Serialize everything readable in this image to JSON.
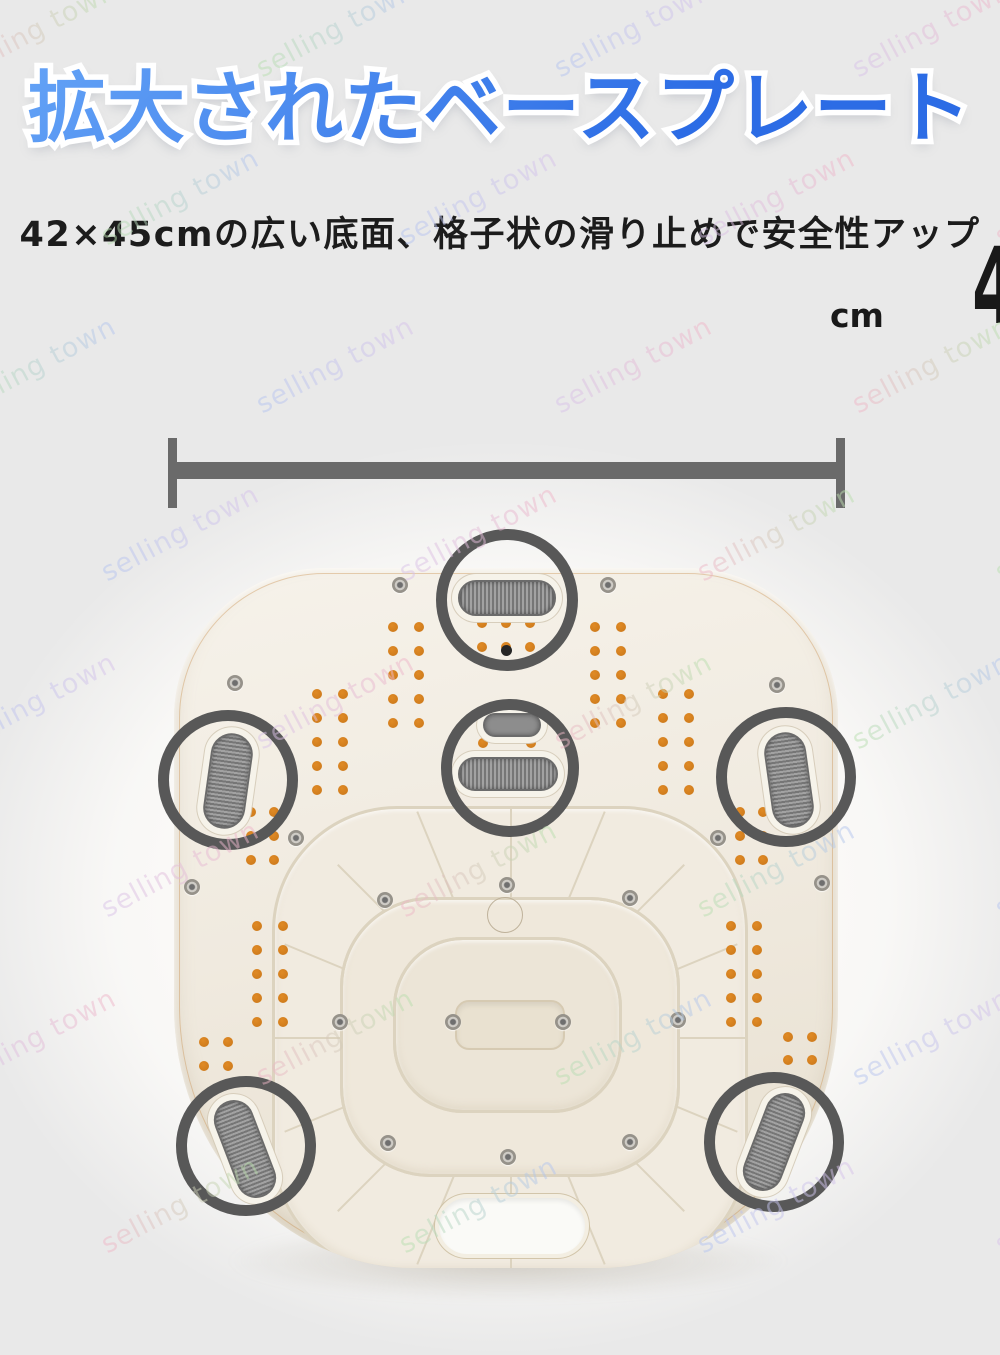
{
  "canvas": {
    "width": 1000,
    "height": 1355,
    "background": "#e9e9e9"
  },
  "header": {
    "title": {
      "text": "拡大されたベースプレート",
      "gradient_top": "#63a2f6",
      "gradient_bottom": "#2c6ce5",
      "outline_color": "#ffffff"
    },
    "subtitle": {
      "text": "42×45cmの広い底面、格子状の滑り止めで安全性アップ",
      "color": "#1c1c1c"
    }
  },
  "dimension": {
    "value": "42×45",
    "unit": "cm",
    "text_color": "#191919",
    "line_color": "#6a6a6a"
  },
  "watermark": {
    "text": "selling town",
    "colors": [
      "#f0b6c8",
      "#b9e0ae",
      "#b4c5f0",
      "#d8c3ea"
    ],
    "opacity": 0.5,
    "rotation_deg": -28,
    "font_size": 27,
    "step_x": 298,
    "step_y": 168,
    "start_y": 14,
    "row_x_offsets": [
      -50,
      -205
    ]
  },
  "photo": {
    "backdrop_color": "#fbfaf8",
    "plate": {
      "left": 174,
      "top": 568,
      "width": 664,
      "height": 700,
      "fill_light": "#f6f2ea",
      "fill_mid": "#f0eadf",
      "fill_dark": "#e7dfcf",
      "edge_line_color": "rgba(200,140,70,0.38)"
    },
    "ring_color": "#585858",
    "rings": [
      {
        "cx": 507,
        "cy": 600,
        "r": 66
      },
      {
        "cx": 228,
        "cy": 780,
        "r": 65
      },
      {
        "cx": 510,
        "cy": 768,
        "r": 64
      },
      {
        "cx": 786,
        "cy": 777,
        "r": 65
      },
      {
        "cx": 246,
        "cy": 1146,
        "r": 65
      },
      {
        "cx": 774,
        "cy": 1142,
        "r": 65
      }
    ],
    "pad_colors": {
      "dark": "#767676",
      "light": "#a2a2a2",
      "base": "#8d8d8d",
      "border": "#6b6b6b"
    },
    "pads": [
      {
        "cx": 507,
        "cy": 598,
        "w": 98,
        "h": 36,
        "rot": 0,
        "ribs": "v"
      },
      {
        "cx": 228,
        "cy": 781,
        "w": 42,
        "h": 96,
        "rot": 8,
        "ribs": "h"
      },
      {
        "cx": 789,
        "cy": 780,
        "w": 42,
        "h": 96,
        "rot": -8,
        "ribs": "h"
      },
      {
        "cx": 512,
        "cy": 725,
        "w": 58,
        "h": 24,
        "rot": 0,
        "ribs": "none"
      },
      {
        "cx": 508,
        "cy": 774,
        "w": 100,
        "h": 34,
        "rot": 0,
        "ribs": "v"
      },
      {
        "cx": 245,
        "cy": 1149,
        "w": 40,
        "h": 102,
        "rot": -21,
        "ribs": "h"
      },
      {
        "cx": 774,
        "cy": 1142,
        "w": 40,
        "h": 102,
        "rot": 21,
        "ribs": "h"
      }
    ],
    "dots": {
      "color": "#c9771a",
      "highlight": "#e08a25",
      "size": 10,
      "clusters": [
        {
          "cols": [
            393,
            419
          ],
          "rows": [
            627,
            651,
            675,
            699,
            723
          ]
        },
        {
          "cols": [
            595,
            621
          ],
          "rows": [
            627,
            651,
            675,
            699,
            723
          ]
        },
        {
          "cols": [
            482,
            506,
            530
          ],
          "rows": [
            623,
            647
          ]
        },
        {
          "cols": [
            483,
            531
          ],
          "rows": [
            743
          ]
        },
        {
          "cols": [
            317,
            343
          ],
          "rows": [
            694,
            718,
            742,
            766,
            790
          ]
        },
        {
          "cols": [
            663,
            689
          ],
          "rows": [
            694,
            718,
            742,
            766,
            790
          ]
        },
        {
          "cols": [
            251,
            274
          ],
          "rows": [
            812,
            836,
            860
          ]
        },
        {
          "cols": [
            740,
            763
          ],
          "rows": [
            812,
            836,
            860
          ]
        },
        {
          "cols": [
            257,
            283
          ],
          "rows": [
            926,
            950,
            974,
            998,
            1022
          ]
        },
        {
          "cols": [
            731,
            757
          ],
          "rows": [
            926,
            950,
            974,
            998,
            1022
          ]
        },
        {
          "cols": [
            204,
            228
          ],
          "rows": [
            1042,
            1066
          ]
        },
        {
          "cols": [
            788,
            812
          ],
          "rows": [
            1037,
            1060
          ]
        }
      ]
    },
    "screws": [
      [
        400,
        585
      ],
      [
        608,
        585
      ],
      [
        235,
        683
      ],
      [
        777,
        685
      ],
      [
        192,
        887
      ],
      [
        822,
        883
      ],
      [
        296,
        838
      ],
      [
        718,
        838
      ],
      [
        507,
        885
      ],
      [
        385,
        900
      ],
      [
        630,
        898
      ],
      [
        340,
        1022
      ],
      [
        453,
        1022
      ],
      [
        563,
        1022
      ],
      [
        678,
        1020
      ],
      [
        388,
        1143
      ],
      [
        630,
        1142
      ],
      [
        508,
        1157
      ]
    ],
    "black_dot": {
      "x": 506,
      "y": 650,
      "d": 11,
      "color": "#262626"
    },
    "boss_circle": {
      "cx": 505,
      "cy": 915,
      "d": 36
    },
    "bowls": [
      {
        "left": 272,
        "top": 806,
        "w": 476,
        "h": 468,
        "r": 125,
        "fill": "#f1ebe0"
      },
      {
        "left": 340,
        "top": 897,
        "w": 340,
        "h": 280,
        "r": 90,
        "fill": "#efe8db"
      },
      {
        "left": 393,
        "top": 937,
        "w": 229,
        "h": 176,
        "r": 70,
        "fill": "#ece5d7"
      }
    ],
    "recess": {
      "left": 455,
      "top": 1000,
      "w": 110,
      "h": 50,
      "r": 14,
      "fill": "#e9e1d0"
    },
    "spokes": {
      "cx": 508,
      "cy": 1035,
      "count": 8,
      "length": 490,
      "width": 2,
      "color": "#dcd3bf"
    },
    "handle": {
      "left": 439,
      "top": 1198,
      "w": 146,
      "h": 56,
      "r": 28,
      "fill": "#fafaf7"
    }
  }
}
